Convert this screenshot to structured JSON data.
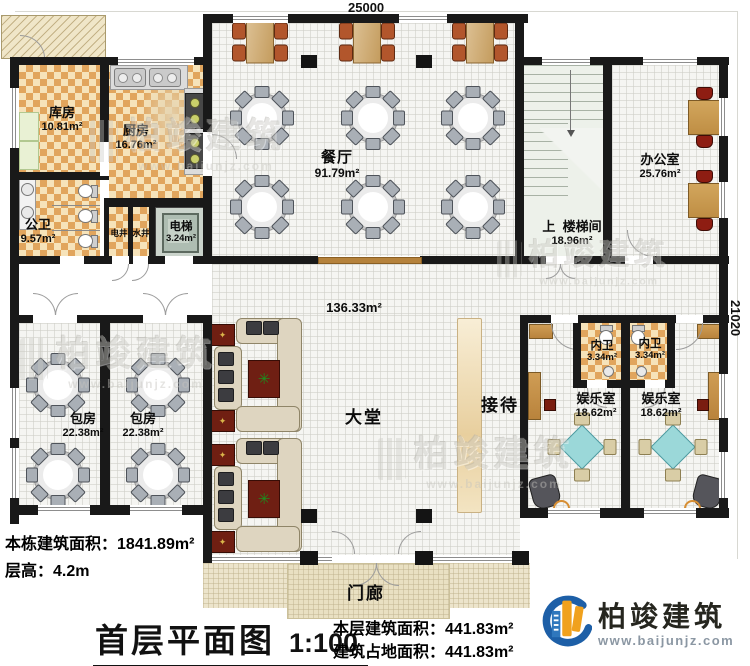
{
  "plan": {
    "dim_top": "25000",
    "dim_right": "21020",
    "rooms": {
      "storage": {
        "name": "库房",
        "area": "10.81m²"
      },
      "kitchen": {
        "name": "厨房",
        "area": "16.76m²"
      },
      "public_wc": {
        "name": "公卫",
        "area": "9.57m²"
      },
      "elec_shaft": {
        "name": "电井"
      },
      "water_shaft": {
        "name": "水井"
      },
      "elevator": {
        "name": "电梯",
        "area": "3.24m²"
      },
      "dining": {
        "name": "餐厅",
        "area": "91.79m²"
      },
      "stair": {
        "prefix": "上",
        "name": "楼梯间",
        "area": "18.96m²"
      },
      "office": {
        "name": "办公室",
        "area": "25.76m²"
      },
      "lobby": {
        "name": "大堂",
        "area": "136.33m²"
      },
      "reception": {
        "name": "接待"
      },
      "private1": {
        "name": "包房",
        "area": "22.38m²"
      },
      "private2": {
        "name": "包房",
        "area": "22.38m²"
      },
      "wc1": {
        "name": "内卫",
        "area": "3.34m²"
      },
      "wc2": {
        "name": "内卫",
        "area": "3.34m²"
      },
      "ent1": {
        "name": "娱乐室",
        "area": "18.62m²"
      },
      "ent2": {
        "name": "娱乐室",
        "area": "18.62m²"
      },
      "porch": {
        "name": "门廊"
      }
    }
  },
  "footer": {
    "total_label": "本栋建筑面积：",
    "total_value": "1841.89m²",
    "height_label": "层高：",
    "height_value": "4.2m",
    "title": "首层平面图",
    "scale": "1:100",
    "floor_label": "本层建筑面积：",
    "floor_value": "441.83m²",
    "footprint_label": "建筑占地面积：",
    "footprint_value": "441.83m²"
  },
  "branding": {
    "company": "柏竣建筑",
    "url": "www.baijunjz.com"
  },
  "watermark": {
    "text": "柏竣建筑",
    "url": "www.baijunjz.com"
  },
  "colors": {
    "wall": "#191919",
    "checker": "#e1a55d",
    "wood": "#cf9d55",
    "accent_blue": "#1d5fa7",
    "accent_orange": "#f0a11d",
    "mahjong": "#9bd8d9",
    "porch": "#ece4cb"
  }
}
